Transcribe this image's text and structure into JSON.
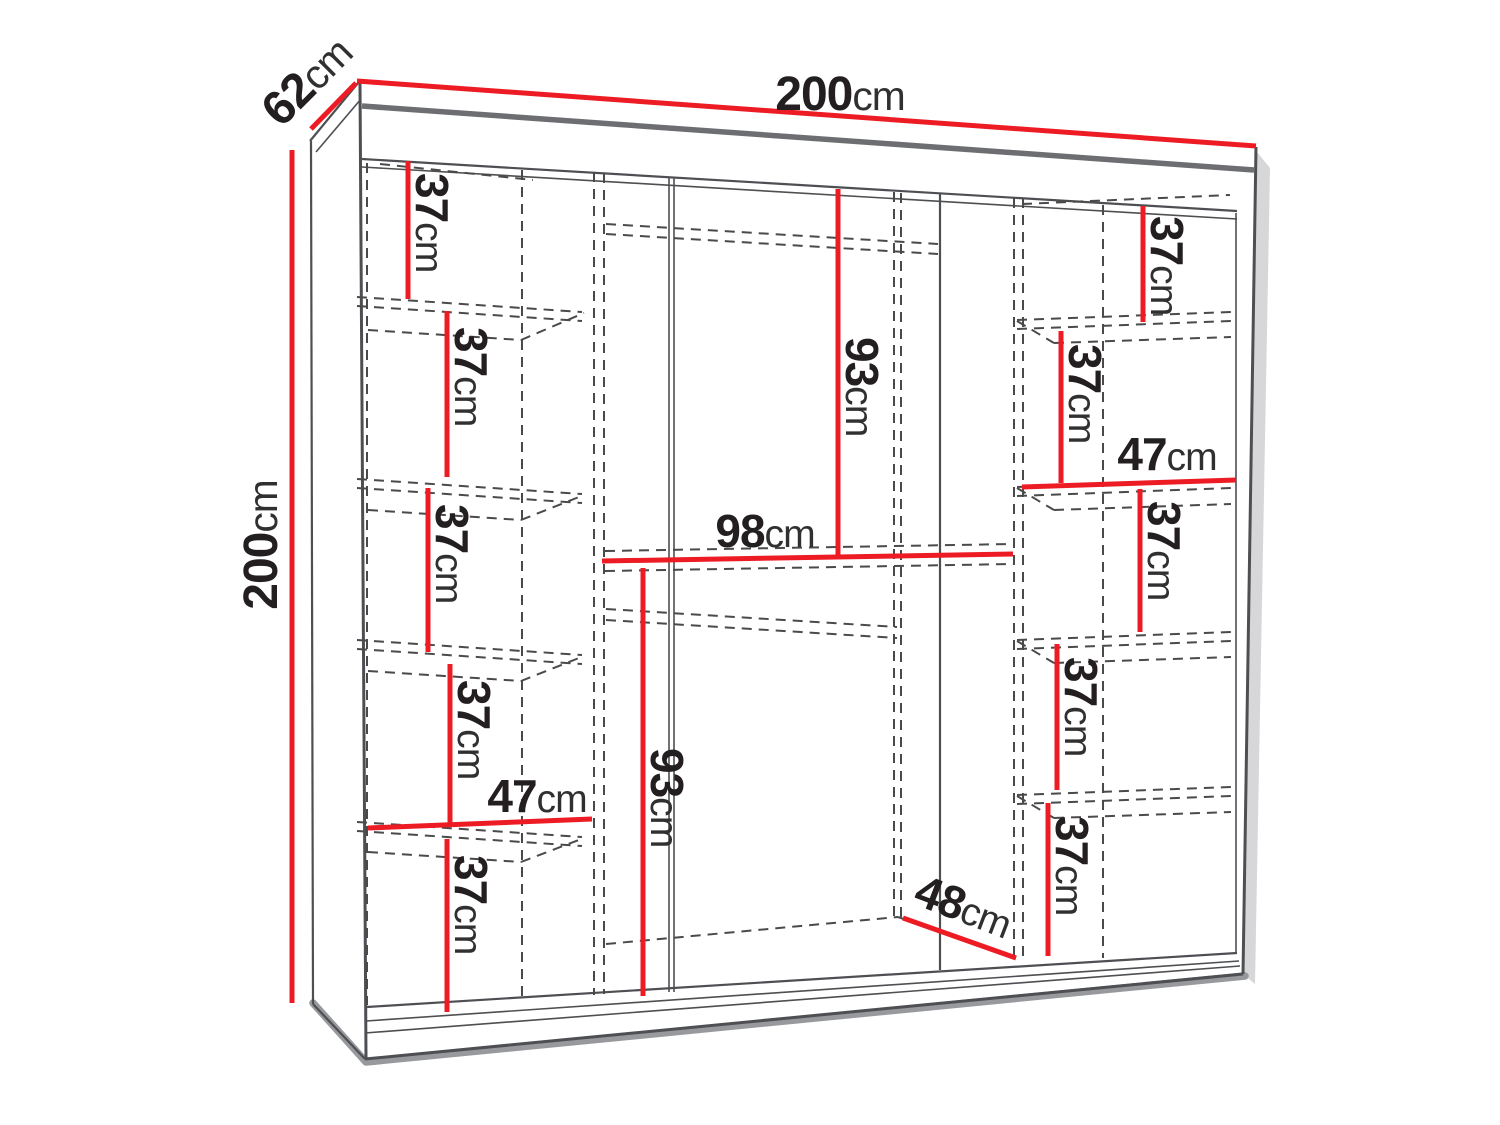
{
  "diagram": {
    "kind": "wardrobe-interior-dimension-drawing",
    "unit": "cm"
  },
  "colors": {
    "background": "#ffffff",
    "dimension_red": "#ed1c24",
    "outline_gray": "#4d4f52",
    "panel_gray": "#6d6e71",
    "hidden_line_gray": "#4a4a4a",
    "shadow_gray": "#97999c",
    "soft_shadow_gray": "#c9cacc",
    "text_black": "#231f20"
  },
  "overall_dimensions": {
    "width": {
      "value": "200",
      "unit": "cm"
    },
    "depth": {
      "value": "62",
      "unit": "cm"
    },
    "height": {
      "value": "200",
      "unit": "cm"
    }
  },
  "measurements": [
    {
      "id": "overall-width",
      "value": "200",
      "unit": "cm"
    },
    {
      "id": "overall-depth",
      "value": "62",
      "unit": "cm"
    },
    {
      "id": "overall-height",
      "value": "200",
      "unit": "cm"
    },
    {
      "id": "left-shelf-1",
      "value": "37",
      "unit": "cm"
    },
    {
      "id": "left-shelf-2",
      "value": "37",
      "unit": "cm"
    },
    {
      "id": "left-shelf-3",
      "value": "37",
      "unit": "cm"
    },
    {
      "id": "left-shelf-4",
      "value": "37",
      "unit": "cm"
    },
    {
      "id": "left-width",
      "value": "47",
      "unit": "cm"
    },
    {
      "id": "left-shelf-5",
      "value": "37",
      "unit": "cm"
    },
    {
      "id": "mid-upper-height",
      "value": "93",
      "unit": "cm"
    },
    {
      "id": "mid-width",
      "value": "98",
      "unit": "cm"
    },
    {
      "id": "mid-lower-height",
      "value": "93",
      "unit": "cm"
    },
    {
      "id": "mid-depth",
      "value": "48",
      "unit": "cm"
    },
    {
      "id": "right-shelf-1",
      "value": "37",
      "unit": "cm"
    },
    {
      "id": "right-shelf-2",
      "value": "37",
      "unit": "cm"
    },
    {
      "id": "right-width",
      "value": "47",
      "unit": "cm"
    },
    {
      "id": "right-shelf-3",
      "value": "37",
      "unit": "cm"
    },
    {
      "id": "right-shelf-4",
      "value": "37",
      "unit": "cm"
    },
    {
      "id": "right-shelf-5",
      "value": "37",
      "unit": "cm"
    }
  ]
}
